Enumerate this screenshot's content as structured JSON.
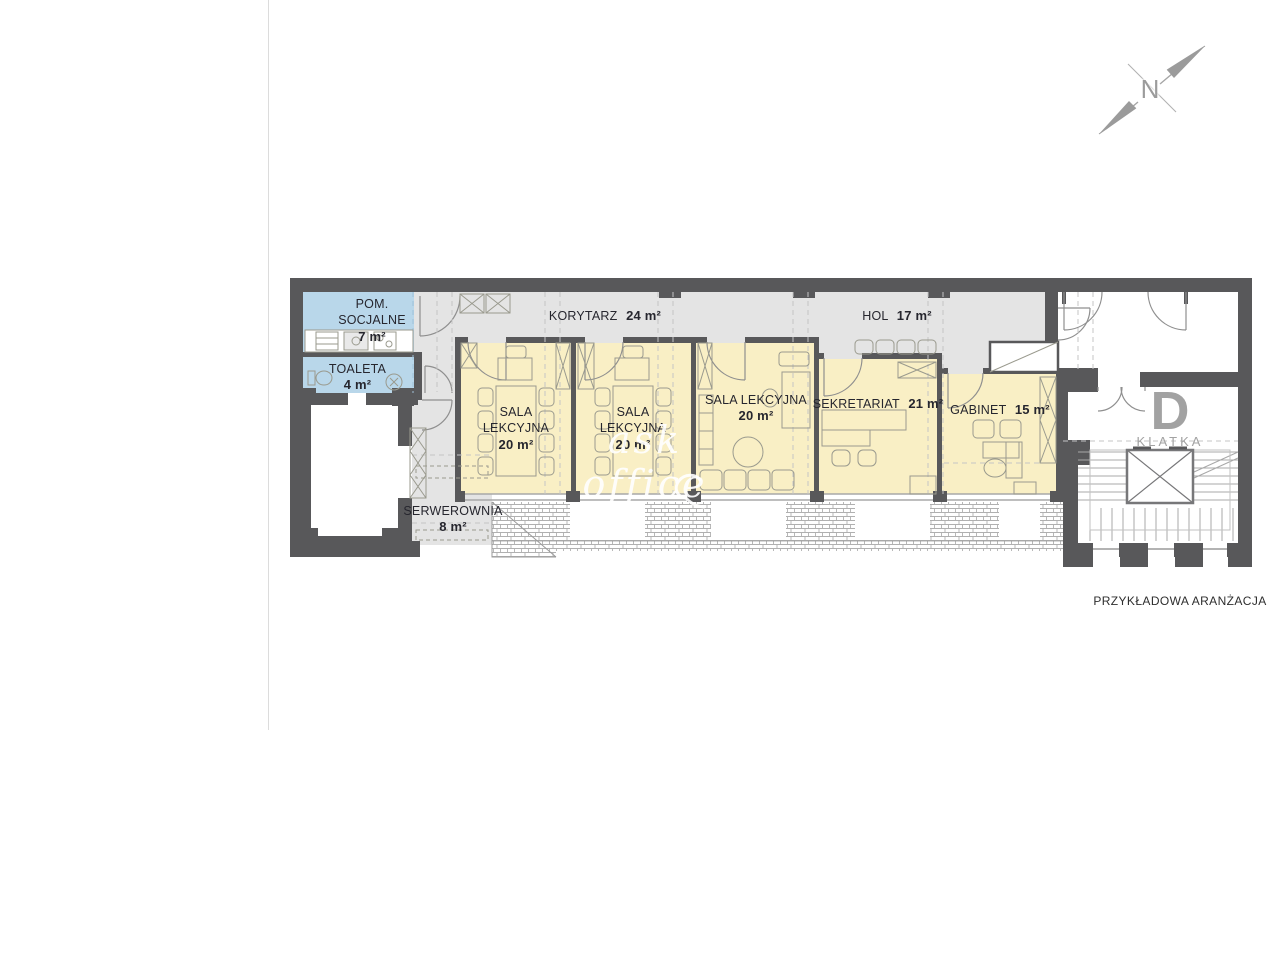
{
  "page": {
    "caption": "PRZYKŁADOWA ARANŻACJA",
    "watermark": "ask office",
    "compass_label": "N"
  },
  "staircase": {
    "letter": "D",
    "label": "KLATKA"
  },
  "rooms": {
    "pom_socjalne": {
      "name": "POM. SOCJALNE",
      "area": "7 m²"
    },
    "toaleta": {
      "name": "TOALETA",
      "area": "4 m²"
    },
    "korytarz": {
      "name": "KORYTARZ",
      "area": "24 m²"
    },
    "sala_1": {
      "name": "SALA LEKCYJNA",
      "area": "20 m²"
    },
    "sala_2": {
      "name": "SALA LEKCYJNA",
      "area": "20 m²"
    },
    "sala_3": {
      "name": "SALA LEKCYJNA",
      "area": "20 m²"
    },
    "sekretariat": {
      "name": "SEKRETARIAT",
      "area": "21 m²"
    },
    "hol": {
      "name": "HOL",
      "area": "17 m²"
    },
    "gabinet": {
      "name": "GABINET",
      "area": "15 m²"
    },
    "serwerownia": {
      "name": "SERWEROWNIA",
      "area": "8 m²"
    }
  },
  "colors": {
    "wall": "#58585a",
    "room_yellow": "#f9efc5",
    "room_blue": "#b9d7ea",
    "corridor_gray": "#e4e4e4",
    "label_text": "#26262e",
    "muted_gray": "#9b9b9b",
    "hatch_line": "#b0b0b0"
  }
}
